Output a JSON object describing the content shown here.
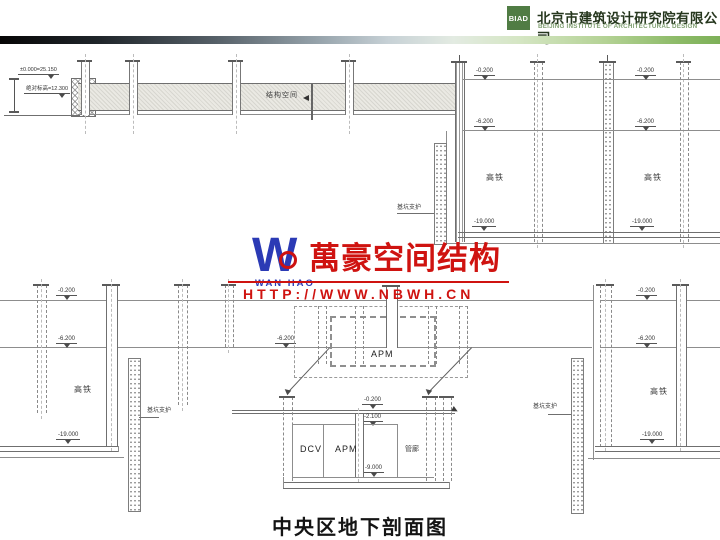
{
  "header": {
    "logo": "BIAD",
    "company_cn": "北京市建筑设计研究院有限公司",
    "company_en": "BEIJING INSTITUTE OF ARCHITECTURAL DESIGN"
  },
  "watermark": {
    "logo_letter": "W",
    "logo_name": "WAN HAO",
    "brand": "萬豪空间结构",
    "url": "HTTP://WWW.NBWH.CN"
  },
  "title": "中央区地下剖面图",
  "labels": {
    "datum_top": "±0.000=25.150",
    "datum_abs": "绝对标高=12.300",
    "structural_space": "结构空间",
    "pit_support": "基坑支护",
    "hsr": "高铁",
    "apm": "APM",
    "dcv": "DCV",
    "pipe_gallery": "管廊",
    "lvl_0200": "-0.200",
    "lvl_2100": "-2.100",
    "lvl_6200": "-6.200",
    "lvl_9000": "-9.000",
    "lvl_19000": "-19.000"
  },
  "colors": {
    "brand_green": "#507c44",
    "watermark_red": "#cc1111",
    "watermark_blue": "#2b3ab5"
  }
}
